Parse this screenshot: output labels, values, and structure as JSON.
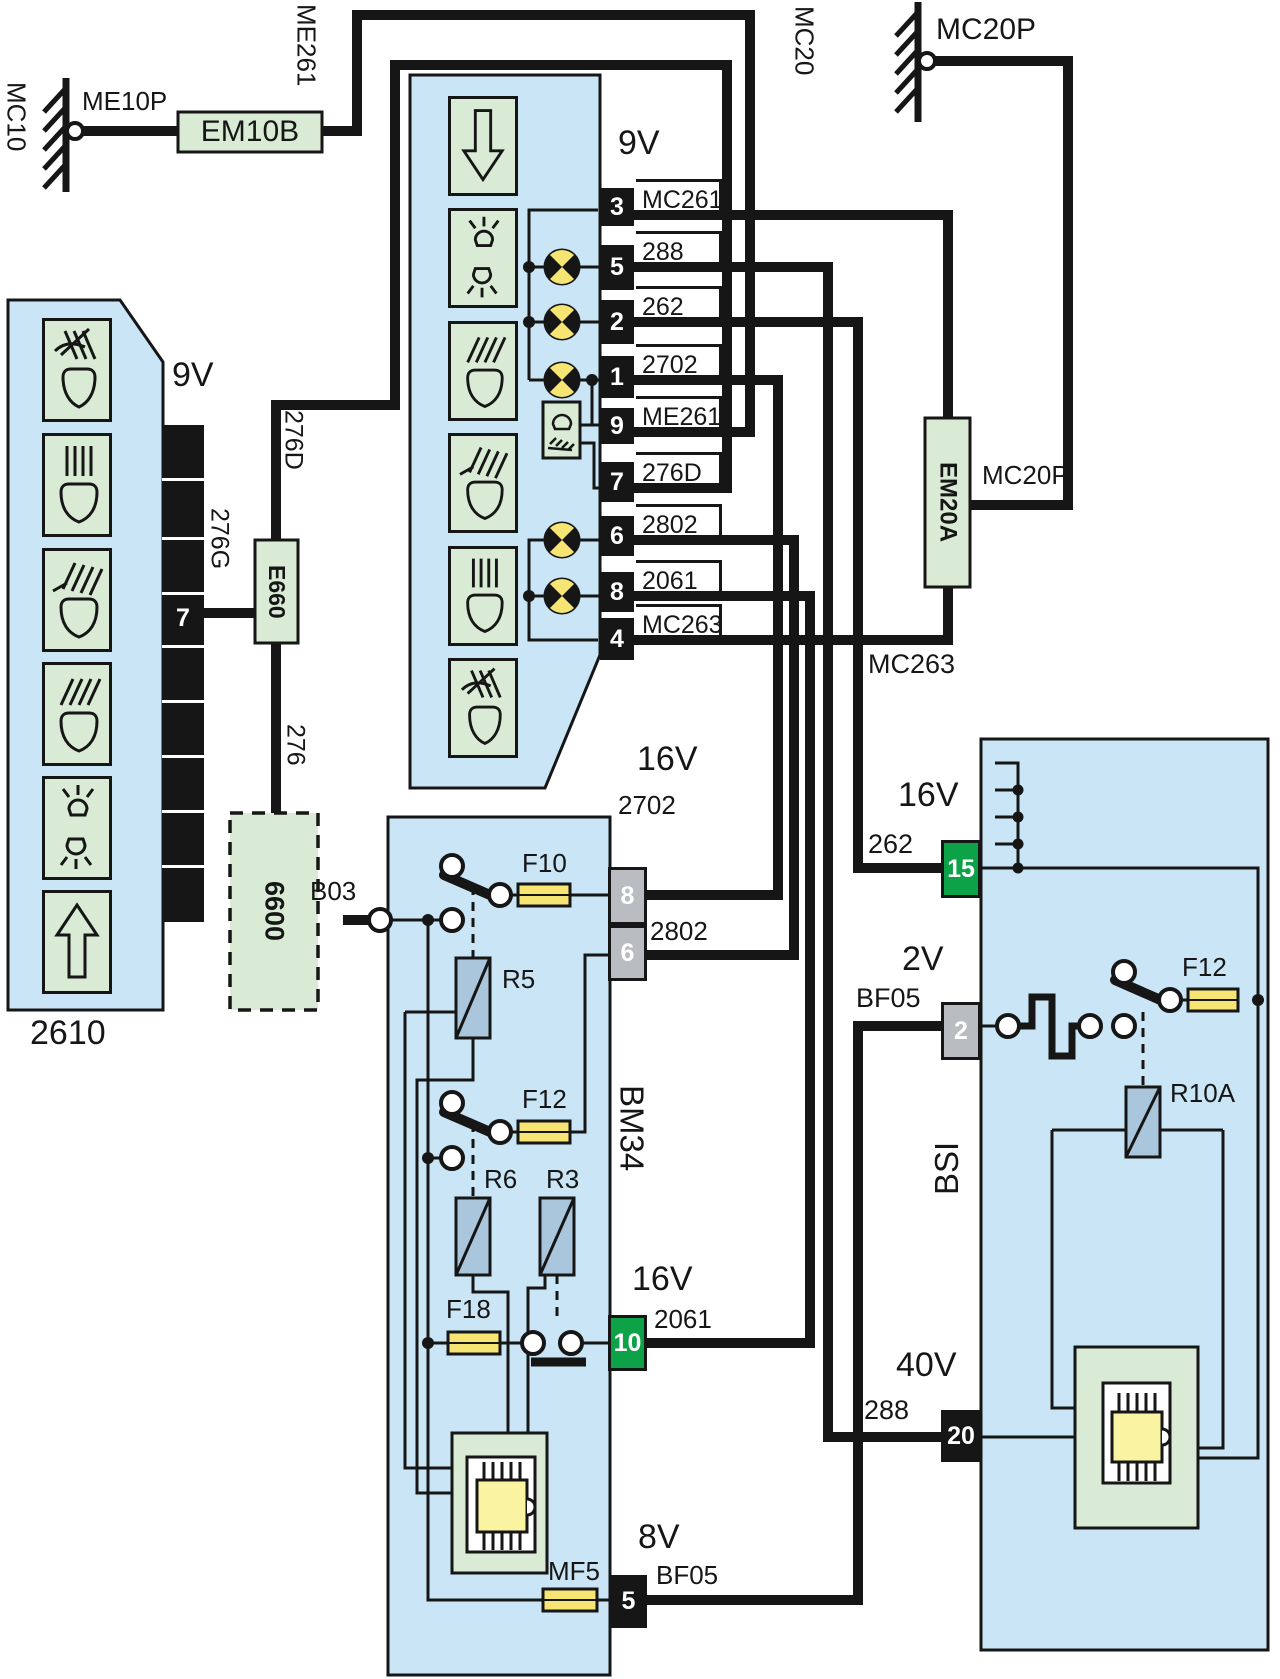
{
  "grounds": {
    "mc10": "MC10",
    "me10p": "ME10P",
    "mc20": "MC20",
    "mc20p_top": "MC20P"
  },
  "em10b": "EM10B",
  "me261_riser": "ME261",
  "unit2610": {
    "id": "2610",
    "voltage": "9V",
    "pin7": "7",
    "w276g": "276G",
    "w276d": "276D",
    "w276": "276",
    "e660": "E660",
    "u6600": "6600",
    "icons": [
      "rear-fog-icon",
      "high-beam-icon",
      "front-fog-icon",
      "low-beam-icon",
      "position-lamps-icon",
      "arrow-up-icon"
    ]
  },
  "lamp_unit": {
    "voltage": "9V",
    "icons": [
      "arrow-down-icon",
      "position-lamps-icon",
      "low-beam-icon",
      "front-fog-icon",
      "high-beam-icon",
      "rear-fog-icon"
    ],
    "rows": [
      {
        "pin": "3",
        "wire": "MC261"
      },
      {
        "pin": "5",
        "wire": "288"
      },
      {
        "pin": "2",
        "wire": "262"
      },
      {
        "pin": "1",
        "wire": "2702"
      },
      {
        "pin": "9",
        "wire": "ME261"
      },
      {
        "pin": "7",
        "wire": "276D"
      },
      {
        "pin": "6",
        "wire": "2802"
      },
      {
        "pin": "8",
        "wire": "2061"
      },
      {
        "pin": "4",
        "wire": "MC263"
      }
    ]
  },
  "em20a": {
    "label": "EM20A",
    "mc20p": "MC20P",
    "mc263": "MC263"
  },
  "bm34": {
    "name": "BM34",
    "b03": "B03",
    "f10": "F10",
    "f12": "F12",
    "f18": "F18",
    "mf5": "MF5",
    "r5": "R5",
    "r6": "R6",
    "r3": "R3",
    "pin8": {
      "pin": "8",
      "wire": "2702",
      "volt": "16V"
    },
    "pin6": {
      "pin": "6",
      "wire": "2802"
    },
    "pin10": {
      "pin": "10",
      "wire": "2061",
      "volt": "16V"
    },
    "pin5": {
      "pin": "5",
      "wire": "BF05",
      "volt": "8V"
    }
  },
  "bsi": {
    "name": "BSI",
    "f12": "F12",
    "r10a": "R10A",
    "pin15": {
      "pin": "15",
      "wire": "262",
      "volt": "16V"
    },
    "pin2": {
      "pin": "2",
      "wire": "BF05",
      "volt": "2V"
    },
    "pin20": {
      "pin": "20",
      "wire": "288",
      "volt": "40V"
    }
  },
  "colors": {
    "block_blue": "#cae5f5",
    "icon_green": "#d9ebd5",
    "fuse_yellow": "#f6e473",
    "chip_yellow": "#faf3a2",
    "relay_blue": "#a9c6dc",
    "pin_green": "#0da148",
    "pin_gray": "#b9bdc1",
    "wire_black": "#161616"
  }
}
